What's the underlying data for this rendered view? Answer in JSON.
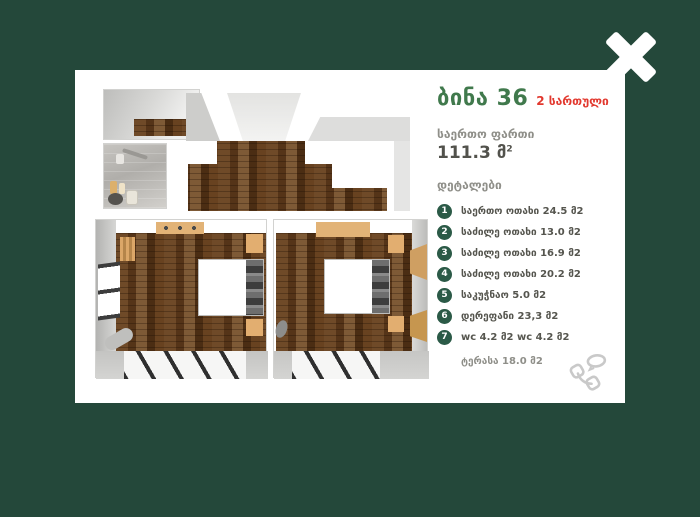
{
  "overlay": {
    "close_label": "close"
  },
  "card": {
    "title": "ბინა 36",
    "floor_badge": "2 სართული",
    "total_area_label": "საერთო ფართი",
    "total_area_value": "111.3 მ",
    "total_area_sup": "2",
    "details_label": "დეტალები",
    "details": [
      {
        "num": "1",
        "label": "საერთო ოთახი 24.5 მ2"
      },
      {
        "num": "2",
        "label": "საძილე ოთახი 13.0 მ2"
      },
      {
        "num": "3",
        "label": "საძილე ოთახი 16.9 მ2"
      },
      {
        "num": "4",
        "label": "საძილე ოთახი 20.2 მ2"
      },
      {
        "num": "5",
        "label": "საკუჭნაო 5.0 მ2"
      },
      {
        "num": "6",
        "label": "დერეფანი 23,3 მ2"
      },
      {
        "num": "7",
        "label": "wc 4.2 მ2  wc 4.2 მ2"
      }
    ],
    "terrace_label": "ტერასა 18.0 მ2"
  },
  "colors": {
    "background_green": "#24483a",
    "card_white": "#ffffff",
    "title_green": "#40794c",
    "floor_red": "#e2382e",
    "circle_green": "#2b5a47",
    "label_gray": "#8f8f89",
    "text_dark": "#52524c",
    "wood_brown": "#6f4a28",
    "furniture_tan": "#e2b377",
    "phone_icon_gray": "#c9c9c9"
  }
}
